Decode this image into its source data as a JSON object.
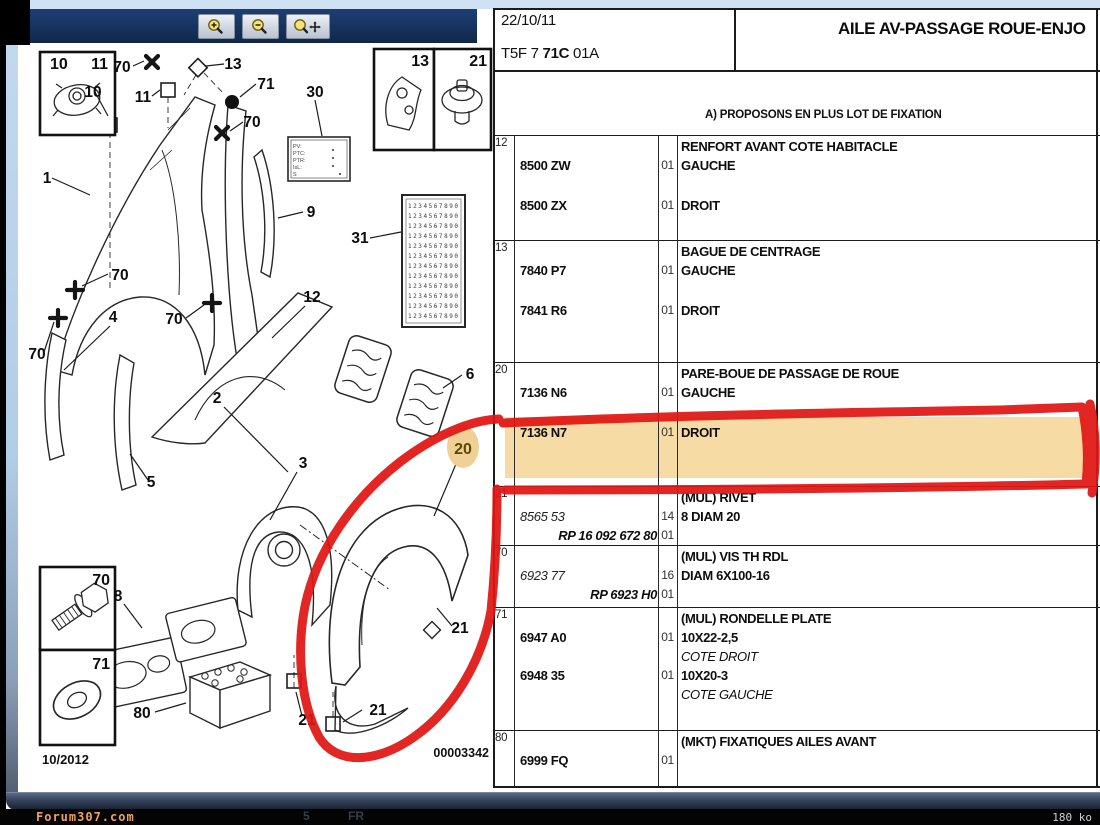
{
  "colors": {
    "accent_navy": "#16325f",
    "row_highlight": "#f7dba4",
    "annotation_red": "#e01512",
    "callout_highlight": "#f0d094"
  },
  "toolbar": {
    "buttons": [
      {
        "name": "zoom-in",
        "icon": "magnifier-plus-icon"
      },
      {
        "name": "zoom-out",
        "icon": "magnifier-minus-icon"
      },
      {
        "name": "zoom-pan",
        "icon": "magnifier-move-icon"
      }
    ]
  },
  "diagram": {
    "callout_labels": {
      "n1": "1",
      "n2": "2",
      "n3": "3",
      "n4": "4",
      "n5": "5",
      "n6": "6",
      "n8": "8",
      "n9": "9",
      "n10": "10",
      "n11": "11",
      "n12": "12",
      "n13": "13",
      "n20": "20",
      "n21": "21",
      "n30": "30",
      "n31": "31",
      "n70": "70",
      "n71": "71",
      "n80": "80"
    },
    "plate30_lines": [
      "PV:",
      "PTC:",
      "PTR:",
      "IsL:",
      "S"
    ],
    "sticker31_row": "1234567890",
    "date_label": "10/2012",
    "drawing_number": "00003342",
    "highlighted_callout": "20"
  },
  "table": {
    "header": {
      "date": "22/10/11",
      "ref_prefix": "T5F 7 ",
      "ref_bold": "71C",
      "ref_suffix": " 01A",
      "title": "AILE AV-PASSAGE ROUE-ENJO"
    },
    "note": "A) PROPOSONS EN PLUS LOT DE FIXATION",
    "rows": [
      {
        "idx": "12",
        "header": "RENFORT AVANT COTE HABITACLE",
        "lines": [
          {
            "part": "8500 ZW",
            "qty": "01",
            "desc": "GAUCHE"
          },
          {
            "part": "8500 ZX",
            "qty": "01",
            "desc": "DROIT"
          }
        ]
      },
      {
        "idx": "13",
        "header": "BAGUE DE CENTRAGE",
        "lines": [
          {
            "part": "7840 P7",
            "qty": "01",
            "desc": "GAUCHE"
          },
          {
            "part": "7841 R6",
            "qty": "01",
            "desc": "DROIT"
          }
        ]
      },
      {
        "idx": "20",
        "header": "PARE-BOUE DE PASSAGE DE ROUE",
        "lines": [
          {
            "part": "7136 N6",
            "qty": "01",
            "desc": "GAUCHE"
          },
          {
            "part": "7136 N7",
            "qty": "01",
            "desc": "DROIT",
            "highlight": true
          }
        ]
      },
      {
        "idx": "21",
        "header": "(MUL) RIVET",
        "lines": [
          {
            "part": "8565 53",
            "part_style": "italic",
            "qty": "14",
            "desc": "8 DIAM 20"
          },
          {
            "part": "RP 16 092 672 80",
            "part_style": "ref",
            "qty": "01",
            "desc": ""
          }
        ]
      },
      {
        "idx": "70",
        "header": "(MUL) VIS TH RDL",
        "lines": [
          {
            "part": "6923 77",
            "part_style": "italic",
            "qty": "16",
            "desc": "DIAM 6X100-16"
          },
          {
            "part": "RP 6923 H0",
            "part_style": "ref",
            "qty": "01",
            "desc": ""
          }
        ]
      },
      {
        "idx": "71",
        "header": "(MUL) RONDELLE PLATE",
        "lines": [
          {
            "part": "6947 A0",
            "qty": "01",
            "desc": "10X22-2,5",
            "desc2": "COTE DROIT"
          },
          {
            "part": "6948 35",
            "qty": "01",
            "desc": "10X20-3",
            "desc2": "COTE GAUCHE"
          }
        ]
      },
      {
        "idx": "80",
        "header": "(MKT) FIXATIQUES AILES AVANT",
        "lines": [
          {
            "part": "6999 FQ",
            "qty": "01",
            "desc": ""
          }
        ]
      }
    ]
  },
  "footer": {
    "watermark": "Forum307.com",
    "page_label": "5",
    "lang_label": "FR",
    "size_label": "180 ko"
  }
}
